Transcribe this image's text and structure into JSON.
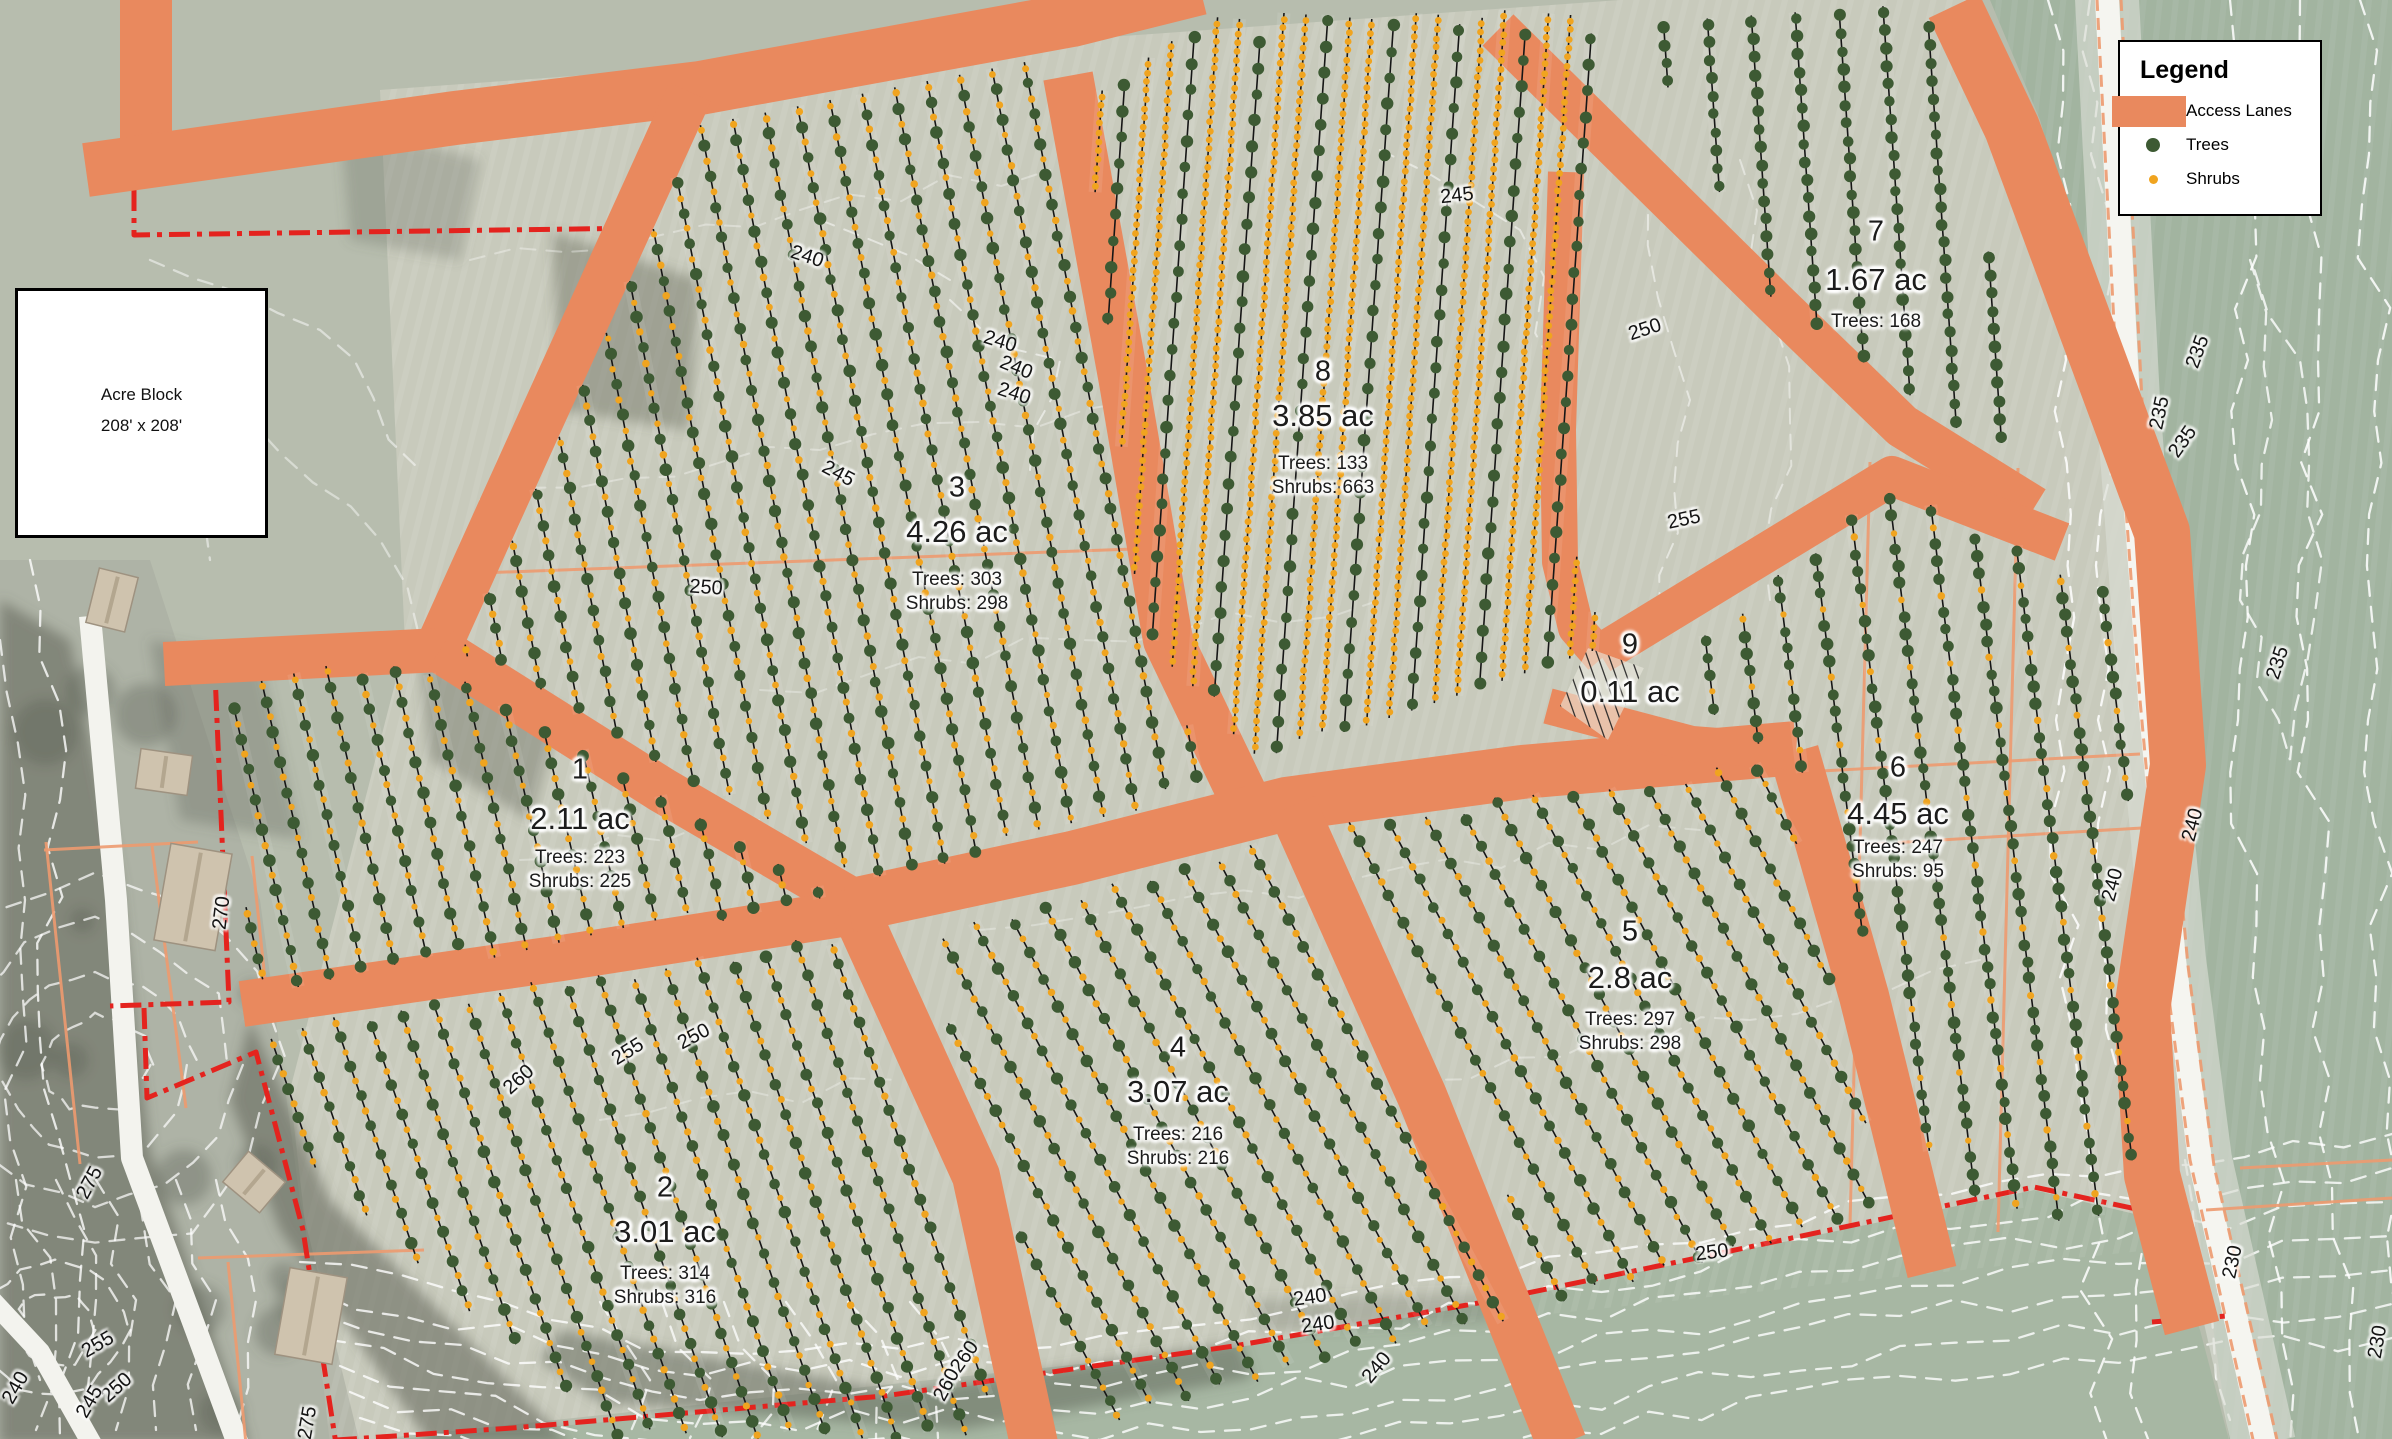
{
  "map": {
    "colors": {
      "lane": "#E9895E",
      "tree": "#3D5A33",
      "shrub": "#F0A41F",
      "boundary_red": "#E4231E",
      "contour_white": "#FFFFFF"
    },
    "legend": {
      "title": "Legend",
      "items": [
        {
          "name": "access-lanes",
          "label": "Access Lanes"
        },
        {
          "name": "trees",
          "label": "Trees"
        },
        {
          "name": "shrubs",
          "label": "Shrubs"
        }
      ]
    },
    "acre_block": {
      "line1": "Acre Block",
      "line2": "208' x 208'"
    },
    "parcels": [
      {
        "num": "1",
        "acreage": "2.11 ac",
        "trees_label": "Trees: 223",
        "shrubs_label": "Shrubs: 225",
        "cx": 580,
        "num_y": 770,
        "ac_y": 819,
        "trees_y": 858,
        "shrubs_y": 882
      },
      {
        "num": "2",
        "acreage": "3.01 ac",
        "trees_label": "Trees: 314",
        "shrubs_label": "Shrubs: 316",
        "cx": 665,
        "num_y": 1188,
        "ac_y": 1232,
        "trees_y": 1274,
        "shrubs_y": 1298
      },
      {
        "num": "3",
        "acreage": "4.26 ac",
        "trees_label": "Trees: 303",
        "shrubs_label": "Shrubs: 298",
        "cx": 957,
        "num_y": 488,
        "ac_y": 532,
        "trees_y": 580,
        "shrubs_y": 604
      },
      {
        "num": "4",
        "acreage": "3.07 ac",
        "trees_label": "Trees: 216",
        "shrubs_label": "Shrubs: 216",
        "cx": 1178,
        "num_y": 1048,
        "ac_y": 1092,
        "trees_y": 1135,
        "shrubs_y": 1159
      },
      {
        "num": "5",
        "acreage": "2.8 ac",
        "trees_label": "Trees: 297",
        "shrubs_label": "Shrubs: 298",
        "cx": 1630,
        "num_y": 932,
        "ac_y": 978,
        "trees_y": 1020,
        "shrubs_y": 1044
      },
      {
        "num": "6",
        "acreage": "4.45 ac",
        "trees_label": "Trees: 247",
        "shrubs_label": "Shrubs: 95",
        "cx": 1898,
        "num_y": 768,
        "ac_y": 814,
        "trees_y": 848,
        "shrubs_y": 872
      },
      {
        "num": "7",
        "acreage": "1.67 ac",
        "trees_label": "Trees: 168",
        "shrubs_label": null,
        "cx": 1876,
        "num_y": 232,
        "ac_y": 280,
        "trees_y": 322,
        "shrubs_y": null
      },
      {
        "num": "8",
        "acreage": "3.85 ac",
        "trees_label": "Trees: 133",
        "shrubs_label": "Shrubs: 663",
        "cx": 1323,
        "num_y": 372,
        "ac_y": 416,
        "trees_y": 464,
        "shrubs_y": 488
      },
      {
        "num": "9",
        "acreage": "0.11 ac",
        "trees_label": null,
        "shrubs_label": null,
        "cx": 1630,
        "num_y": 645,
        "ac_y": 692,
        "trees_y": null,
        "shrubs_y": null
      }
    ],
    "contour_labels": [
      [
        "240",
        807,
        257,
        18
      ],
      [
        "240",
        1000,
        342,
        17
      ],
      [
        "240",
        1016,
        368,
        22
      ],
      [
        "240",
        1014,
        394,
        18
      ],
      [
        "245",
        838,
        474,
        28
      ],
      [
        "250",
        706,
        588,
        4
      ],
      [
        "245",
        1457,
        196,
        -6
      ],
      [
        "250",
        1645,
        330,
        -18
      ],
      [
        "255",
        1684,
        520,
        -12
      ],
      [
        "250",
        694,
        1037,
        -28
      ],
      [
        "255",
        628,
        1052,
        -32
      ],
      [
        "260",
        519,
        1080,
        -42
      ],
      [
        "260",
        965,
        1357,
        -55
      ],
      [
        "260",
        947,
        1385,
        -62
      ],
      [
        "240",
        1310,
        1298,
        -8
      ],
      [
        "240",
        1318,
        1325,
        -8
      ],
      [
        "240",
        1377,
        1368,
        -50
      ],
      [
        "250",
        1712,
        1253,
        -7
      ],
      [
        "270",
        222,
        913,
        -83
      ],
      [
        "275",
        90,
        1183,
        -62
      ],
      [
        "255",
        98,
        1345,
        -30
      ],
      [
        "250",
        117,
        1388,
        -42
      ],
      [
        "245",
        90,
        1402,
        -60
      ],
      [
        "240",
        16,
        1388,
        -60
      ],
      [
        "275",
        308,
        1423,
        -80
      ],
      [
        "235",
        2198,
        352,
        -70
      ],
      [
        "235",
        2160,
        413,
        -78
      ],
      [
        "235",
        2183,
        442,
        -55
      ],
      [
        "235",
        2278,
        663,
        -72
      ],
      [
        "240",
        2193,
        825,
        -75
      ],
      [
        "240",
        2113,
        885,
        -75
      ],
      [
        "230",
        2233,
        1262,
        -78
      ],
      [
        "230",
        2378,
        1342,
        -80
      ]
    ]
  }
}
